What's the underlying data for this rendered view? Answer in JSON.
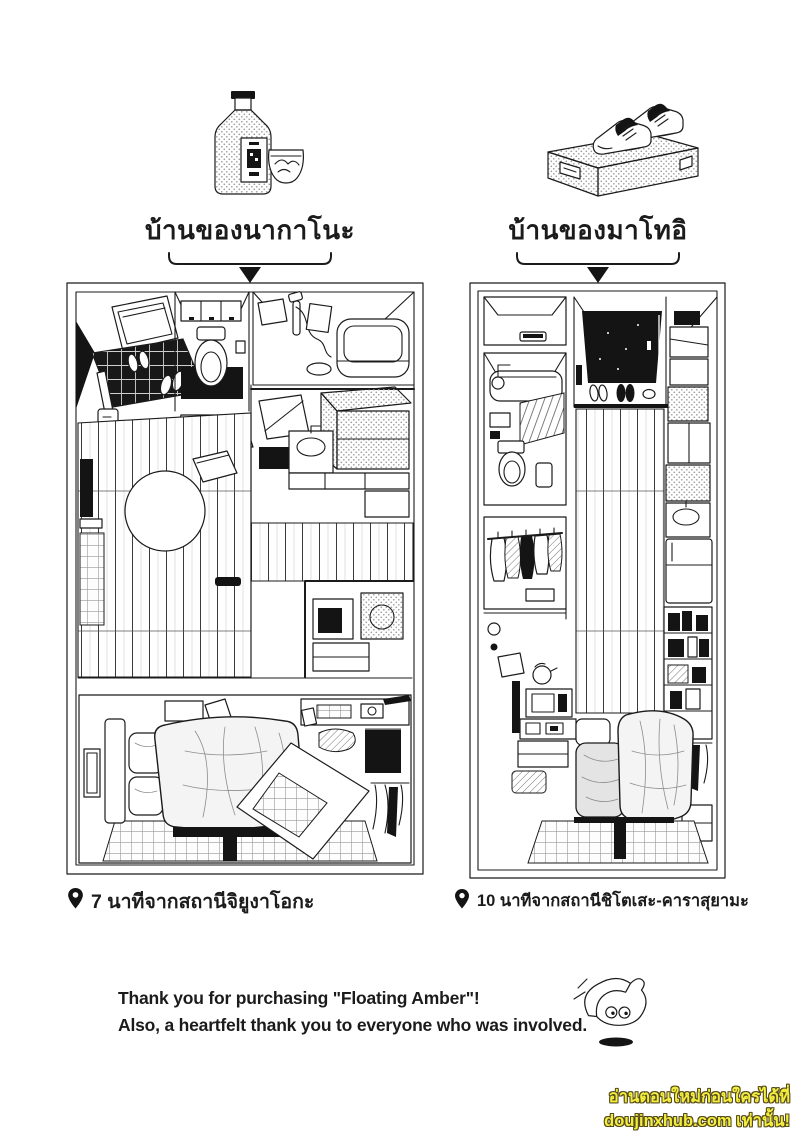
{
  "page": {
    "background": "#ffffff",
    "ink": "#1b1b1b"
  },
  "intro_items": {
    "left_icon": "whisky-bottle-and-glass-icon",
    "right_icon": "sneakers-on-shoebox-icon"
  },
  "homes": {
    "left": {
      "label": "บ้านของนากาโนะ",
      "floorplan": "nakano-apartment-isometric-floorplan",
      "pin_icon": "map-pin-icon",
      "station_note": "7 นาทีจากสถานีจิยูงาโอกะ"
    },
    "right": {
      "label": "บ้านของมาโทอิ",
      "floorplan": "matoi-apartment-isometric-floorplan",
      "pin_icon": "map-pin-icon",
      "station_note": "10 นาทีจากสถานีชิโตเสะ-คาราสุยามะ"
    }
  },
  "afterword": {
    "line1": "Thank you for purchasing \"Floating Amber\"!",
    "line2": "Also, a heartfelt thank you to everyone who was involved.",
    "doodle_icon": "chibi-head-doodle"
  },
  "watermark": {
    "line1": "อ่านตอนใหม่ก่อนใครได้ที่",
    "line2": "doujinxhub.com เท่านั้น!",
    "text_color": "#f2ee3e",
    "outline_color": "#55491c"
  }
}
